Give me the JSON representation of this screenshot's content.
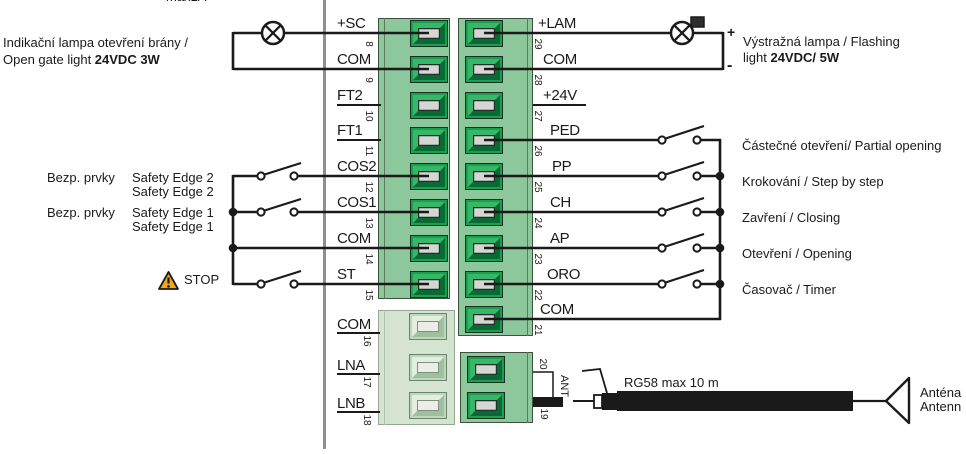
{
  "top_note": "max1A",
  "left_annotations": {
    "open_gate_line1": "Indikační lampa otevření brány /",
    "open_gate_line2_normal": "Open gate light ",
    "open_gate_line2_bold": "24VDC 3W",
    "safety_prefix": "Bezp. prvky",
    "safety2_line1": "Safety Edge 2",
    "safety2_line2": "Safety Edge 2",
    "safety1_line1": "Safety Edge 1",
    "safety1_line2": "Safety Edge 1",
    "stop": "STOP"
  },
  "right_annotations": {
    "flashing_line1": "Výstražná lampa / Flashing",
    "flashing_line2_normal": "light ",
    "flashing_line2_bold": "24VDC/ 5W",
    "plus": "+",
    "minus": "-",
    "switch_labels": [
      "Částečné otevření/ Partial opening",
      "Krokování / Step by step",
      "Zavření / Closing",
      "Otevření / Opening",
      "Časovač / Timer"
    ]
  },
  "antenna": {
    "cable_label": "RG58 max 10 m",
    "port_label": "ANT",
    "line1": "Anténa",
    "line2": "Antenn"
  },
  "terminal_blocks": {
    "left": {
      "pins": [
        {
          "label": "+SC",
          "number": "8",
          "connected": true
        },
        {
          "label": "COM",
          "number": "9",
          "connected": true
        },
        {
          "label": "FT2",
          "number": "10",
          "connected": false
        },
        {
          "label": "FT1",
          "number": "11",
          "connected": false
        },
        {
          "label": "COS2",
          "number": "12",
          "connected": true
        },
        {
          "label": "COS1",
          "number": "13",
          "connected": true
        },
        {
          "label": "COM",
          "number": "14",
          "connected": true
        },
        {
          "label": "ST",
          "number": "15",
          "connected": true
        }
      ]
    },
    "lower_left": {
      "pins": [
        {
          "label": "COM",
          "number": "16",
          "connected": false
        },
        {
          "label": "LNA",
          "number": "17",
          "connected": false
        },
        {
          "label": "LNB",
          "number": "18",
          "connected": false
        }
      ]
    },
    "right": {
      "pins": [
        {
          "label": "+LAM",
          "number": "29",
          "connected": true
        },
        {
          "label": "COM",
          "number": "28",
          "connected": true
        },
        {
          "label": "+24V",
          "number": "27",
          "connected": false
        },
        {
          "label": "PED",
          "number": "26",
          "connected": true
        },
        {
          "label": "PP",
          "number": "25",
          "connected": true
        },
        {
          "label": "CH",
          "number": "24",
          "connected": true
        },
        {
          "label": "AP",
          "number": "23",
          "connected": true
        },
        {
          "label": "ORO",
          "number": "22",
          "connected": true
        },
        {
          "label": "COM",
          "number": "21",
          "connected": true
        }
      ]
    },
    "ant": {
      "pins": [
        {
          "number": "20",
          "connected": false
        },
        {
          "number": "19",
          "connected": true
        }
      ]
    }
  },
  "colors": {
    "wire": "#1a1a1a",
    "block_green": "#8dc89c",
    "terminal_green": "#17a04f",
    "terminal_center": "#d6d6d2",
    "pale_block": "#d4e4d1",
    "stop_yellow": "#f2a71d",
    "divider_grey": "#8f8f8f"
  }
}
